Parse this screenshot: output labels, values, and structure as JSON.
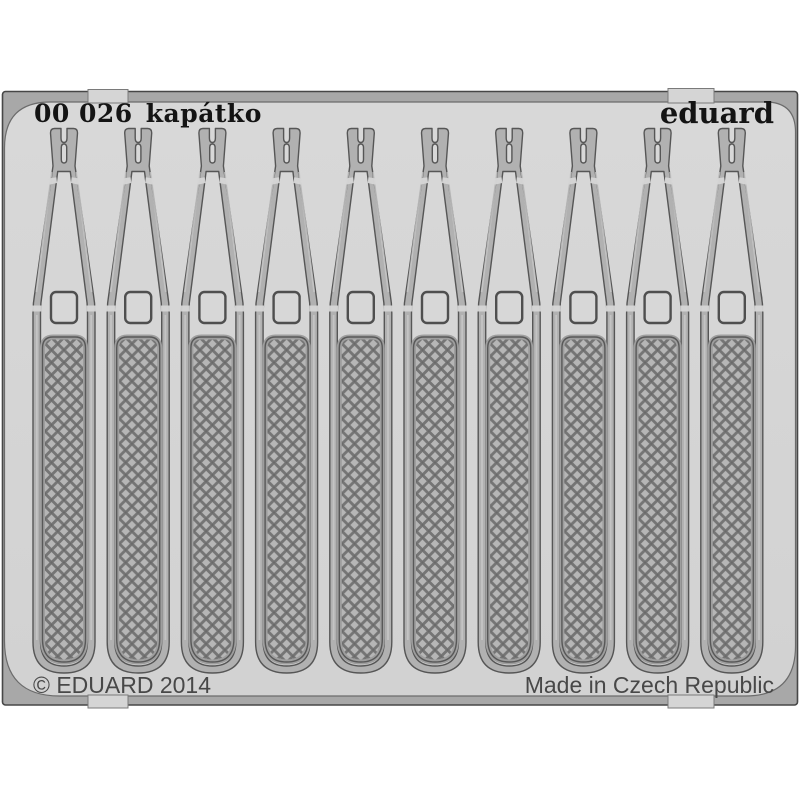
{
  "product_photo": {
    "header": {
      "catalog_number": "00 026",
      "product_name": "kapátko",
      "brand_logo": "eduard"
    },
    "footer": {
      "copyright": "© EDUARD 2014",
      "origin": "Made in Czech Republic"
    },
    "parts": {
      "count": 10,
      "part_name": "kapátko",
      "first_center_x": 64,
      "spacing_x": 74.2
    },
    "colors": {
      "background": "#ffffff",
      "sheet_surface": "#d5d5d5",
      "frame_metal": "#a8a8a8",
      "part_metal": "#b1b1b1",
      "mesh_line": "#757575",
      "outline": "#565656",
      "header_text": "#141414",
      "footer_text": "#484848"
    }
  }
}
